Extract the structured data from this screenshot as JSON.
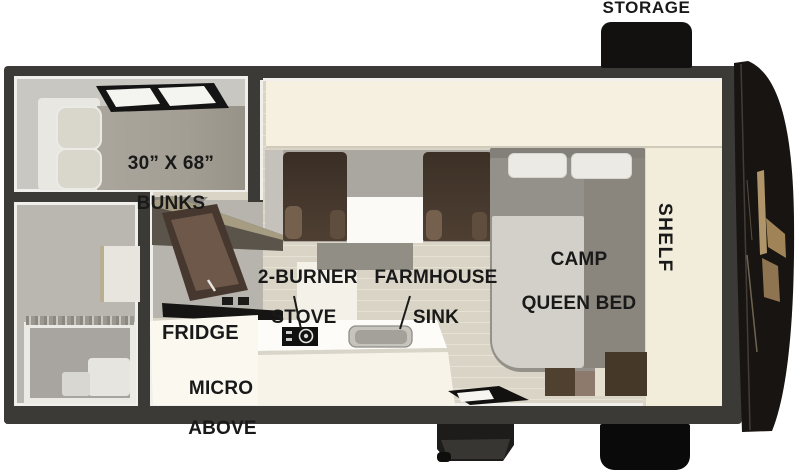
{
  "diagram_type": "truck-camper-floorplan",
  "colors": {
    "wall": "#3b3a37",
    "trim": "#f0efec",
    "cream": "#f5f0e0",
    "cream2": "#f2edda",
    "floor": "#d9d4c6",
    "plank": "#e5e1d3",
    "ink": "#121110",
    "gold": "#b0956b",
    "label": "#191919",
    "chair": "#46382c",
    "bedgray": "#94908a",
    "sheet": "#d3d0c9"
  },
  "exterior": {
    "storage": "STORAGE"
  },
  "rooms": {
    "bunks": {
      "line1": "30” X 68”",
      "line2": "BUNKS"
    },
    "kitchen": {
      "stove": {
        "line1": "2-BURNER",
        "line2": "STOVE"
      },
      "sink": {
        "line1": "FARMHOUSE",
        "line2": "SINK"
      },
      "fridge": "FRIDGE",
      "micro": {
        "line1": "MICRO",
        "line2": "ABOVE"
      }
    },
    "bedroom": {
      "bed_line1": "CAMP",
      "bed_line2": "QUEEN BED",
      "shelf": "SHELF"
    }
  }
}
